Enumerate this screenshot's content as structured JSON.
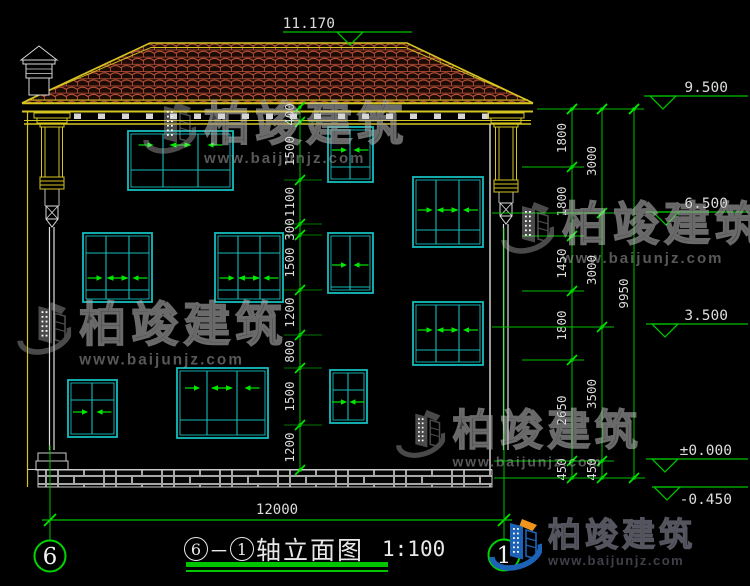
{
  "page": {
    "width": 750,
    "height": 586,
    "background": "#000000"
  },
  "colors": {
    "cad_yellow": "#d4c520",
    "cad_cyan": "#14bdbd",
    "cad_green": "#00bf00",
    "tick_green": "#00e800",
    "tile_red_dark": "#a84832",
    "tile_red_light": "#c4563a",
    "line_white": "#dcdcdc",
    "logo_blue": "#1c63b7",
    "logo_orange": "#f0941d"
  },
  "watermark": {
    "brand": "柏竣建筑",
    "url": "www.baijunjz.com",
    "instances": [
      {
        "x": 140,
        "y": 100,
        "size": 1.0
      },
      {
        "x": 14,
        "y": 300,
        "size": 1.02
      },
      {
        "x": 498,
        "y": 200,
        "size": 1.0
      },
      {
        "x": 393,
        "y": 408,
        "size": 0.93
      }
    ]
  },
  "logo": {
    "brand": "柏竣建筑",
    "url": "www.baijunjz.com",
    "x": 486,
    "y": 517
  },
  "title_block": {
    "axis_start": "6",
    "axis_end": "1",
    "dash": "－",
    "title_text": "轴立面图",
    "scale_label": "1:100"
  },
  "elevation_marks": [
    {
      "label": "11.170",
      "line_y": 32,
      "line_x1": 283,
      "line_x2": 412,
      "tri_x": 337,
      "text_x": 335,
      "text_side": "above"
    },
    {
      "label": "9.500",
      "line_y": 96,
      "line_x1": 644,
      "line_x2": 748,
      "tri_x": 650,
      "text_x": 728,
      "text_side": "above"
    },
    {
      "label": "6.500",
      "line_y": 212,
      "line_x1": 646,
      "line_x2": 748,
      "tri_x": 653,
      "text_x": 728,
      "text_side": "above"
    },
    {
      "label": "3.500",
      "line_y": 324,
      "line_x1": 646,
      "line_x2": 748,
      "tri_x": 652,
      "text_x": 728,
      "text_side": "above"
    },
    {
      "label": "±0.000",
      "line_y": 459,
      "line_x1": 646,
      "line_x2": 748,
      "tri_x": 652,
      "text_x": 732,
      "text_side": "above"
    },
    {
      "label": "-0.450",
      "line_y": 487,
      "line_x1": 652,
      "line_x2": 748,
      "tri_x": 654,
      "text_x": 732,
      "text_side": "below"
    }
  ],
  "dimension_chains": [
    {
      "x": 300,
      "boundaries": [
        107,
        122,
        180,
        224,
        235,
        290,
        335,
        368,
        425,
        470
      ],
      "labels": [
        "400",
        "1500",
        "1100",
        "300",
        "1500",
        "1200",
        "800",
        "1500",
        "1200"
      ]
    },
    {
      "x": 572,
      "boundaries": [
        109,
        167,
        236,
        291,
        360,
        461,
        478
      ],
      "labels": [
        "1800",
        "1800",
        "1450",
        "1800",
        "2650",
        "450"
      ]
    },
    {
      "x": 602,
      "boundaries": [
        109,
        213,
        327,
        461,
        478
      ],
      "labels": [
        "3000",
        "3000",
        "3500",
        "450"
      ]
    },
    {
      "x": 634,
      "boundaries": [
        109,
        478
      ],
      "labels": [
        "9950"
      ]
    }
  ],
  "connector_lines": [
    {
      "x1": 537,
      "y1": 109,
      "x2": 644,
      "y2": 109
    },
    {
      "x1": 522,
      "y1": 167,
      "x2": 584,
      "y2": 167
    },
    {
      "x1": 492,
      "y1": 213,
      "x2": 614,
      "y2": 213
    },
    {
      "x1": 522,
      "y1": 236,
      "x2": 584,
      "y2": 236
    },
    {
      "x1": 522,
      "y1": 291,
      "x2": 584,
      "y2": 291
    },
    {
      "x1": 492,
      "y1": 327,
      "x2": 614,
      "y2": 327
    },
    {
      "x1": 522,
      "y1": 360,
      "x2": 584,
      "y2": 360
    },
    {
      "x1": 494,
      "y1": 461,
      "x2": 614,
      "y2": 461
    },
    {
      "x1": 494,
      "y1": 478,
      "x2": 645,
      "y2": 478
    }
  ],
  "bottom_dimension": {
    "label": "12000",
    "y": 520,
    "x1": 50,
    "x2": 504,
    "text_x": 277,
    "text_y": 514
  },
  "axes": [
    {
      "label": "6",
      "x": 50,
      "line_y1": 445,
      "line_y2": 540,
      "circle_y": 556
    },
    {
      "label": "1",
      "x": 504,
      "line_y1": 228,
      "line_y2": 539,
      "circle_y": 555
    }
  ],
  "windows": [
    {
      "x": 128,
      "y": 131,
      "w": 105,
      "h": 59,
      "mullions": [
        163,
        198
      ],
      "hlines": [
        170
      ],
      "arrow_y": 145,
      "arrows": [
        "r",
        "lr",
        "l"
      ]
    },
    {
      "x": 328,
      "y": 127,
      "w": 45,
      "h": 55,
      "mullions": [
        350
      ],
      "hlines": [
        167
      ],
      "arrow_y": 150,
      "arrows": [
        "r",
        "l"
      ]
    },
    {
      "x": 413,
      "y": 177,
      "w": 70,
      "h": 70,
      "mullions": [
        436,
        459
      ],
      "hlines": [
        230
      ],
      "arrow_y": 210,
      "arrows": [
        "r",
        "lr",
        "l"
      ]
    },
    {
      "x": 83,
      "y": 233,
      "w": 69,
      "h": 69,
      "mullions": [
        106,
        129
      ],
      "hlines": [
        253,
        290
      ],
      "arrow_y": 278,
      "arrows": [
        "r",
        "lr",
        "l"
      ]
    },
    {
      "x": 215,
      "y": 233,
      "w": 68,
      "h": 69,
      "mullions": [
        238,
        260
      ],
      "hlines": [
        253,
        290
      ],
      "arrow_y": 278,
      "arrows": [
        "r",
        "lr",
        "l"
      ]
    },
    {
      "x": 328,
      "y": 233,
      "w": 45,
      "h": 60,
      "mullions": [
        350
      ],
      "hlines": [
        287
      ],
      "arrow_y": 265,
      "arrows": [
        "r",
        "l"
      ]
    },
    {
      "x": 413,
      "y": 302,
      "w": 70,
      "h": 63,
      "mullions": [
        436,
        459
      ],
      "hlines": [
        350
      ],
      "arrow_y": 330,
      "arrows": [
        "r",
        "lr",
        "l"
      ]
    },
    {
      "x": 68,
      "y": 380,
      "w": 49,
      "h": 57,
      "mullions": [
        92
      ],
      "hlines": [
        400
      ],
      "arrow_y": 412,
      "arrows": [
        "r",
        "l"
      ]
    },
    {
      "x": 177,
      "y": 368,
      "w": 91,
      "h": 70,
      "mullions": [
        207,
        237
      ],
      "hlines": [
        420
      ],
      "arrow_y": 388,
      "arrows": [
        "r",
        "lr",
        "l"
      ]
    },
    {
      "x": 330,
      "y": 370,
      "w": 37,
      "h": 53,
      "mullions": [
        348
      ],
      "hlines": [
        390
      ],
      "arrow_y": 402,
      "arrows": [
        "r",
        "l"
      ]
    }
  ]
}
